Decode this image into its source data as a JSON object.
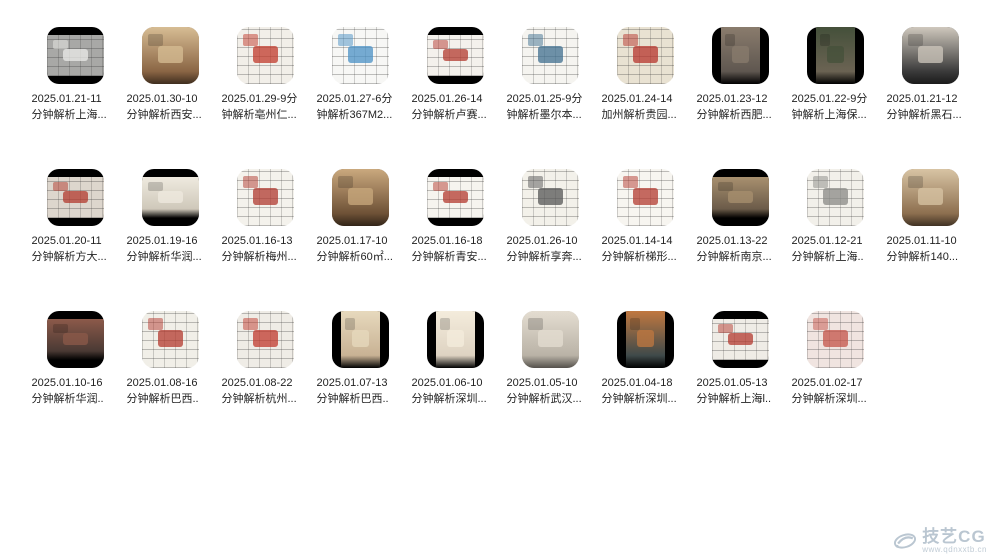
{
  "watermark": {
    "brand": "技艺CG",
    "url": "www.qdnxxtb.cn",
    "color": "#aebdc9"
  },
  "grid": {
    "rows": [
      [
        {
          "date_line": "2025.01.21-11",
          "title_line": "分钟解析上海...",
          "thumb": {
            "kind": "plan",
            "bars": "h",
            "base": "#a8a8a6",
            "accent": "#ebebe8"
          }
        },
        {
          "date_line": "2025.01.30-10",
          "title_line": "分钟解析西安...",
          "thumb": {
            "kind": "photo",
            "bars": "none",
            "base": "#8a6544",
            "accent": "#d7bd94"
          }
        },
        {
          "date_line": "2025.01.29-9分",
          "title_line": "钟解析亳州仁...",
          "thumb": {
            "kind": "plan",
            "bars": "none",
            "base": "#f2efe9",
            "accent": "#c0392b"
          }
        },
        {
          "date_line": "2025.01.27-6分",
          "title_line": "钟解析367M2...",
          "thumb": {
            "kind": "plan",
            "bars": "none",
            "base": "#f7f7f5",
            "accent": "#4a90c4"
          }
        },
        {
          "date_line": "2025.01.26-14",
          "title_line": "分钟解析卢赛...",
          "thumb": {
            "kind": "plan",
            "bars": "h",
            "base": "#f4f1ec",
            "accent": "#b3392f"
          }
        },
        {
          "date_line": "2025.01.25-9分",
          "title_line": "钟解析墨尔本...",
          "thumb": {
            "kind": "plan",
            "bars": "none",
            "base": "#f5f4f0",
            "accent": "#3f6f8f"
          }
        },
        {
          "date_line": "2025.01.24-14",
          "title_line": "加州解析贵园...",
          "thumb": {
            "kind": "plan",
            "bars": "none",
            "base": "#e9e2d2",
            "accent": "#b5342c"
          }
        },
        {
          "date_line": "2025.01.23-12",
          "title_line": "分钟解析西肥...",
          "thumb": {
            "kind": "photo",
            "bars": "v",
            "base": "#5f5750",
            "accent": "#8a7c6d"
          }
        },
        {
          "date_line": "2025.01.22-9分",
          "title_line": "钟解析上海保...",
          "thumb": {
            "kind": "photo",
            "bars": "v",
            "base": "#6b6353",
            "accent": "#44503a"
          }
        },
        {
          "date_line": "2025.01.21-12",
          "title_line": "分钟解析黑石...",
          "thumb": {
            "kind": "photo",
            "bars": "none",
            "base": "#3a3a3a",
            "accent": "#cfc8bd"
          }
        }
      ],
      [
        {
          "date_line": "2025.01.20-11",
          "title_line": "分钟解析方大...",
          "thumb": {
            "kind": "plan",
            "bars": "h",
            "base": "#ddd6cd",
            "accent": "#b23a2e"
          }
        },
        {
          "date_line": "2025.01.19-16",
          "title_line": "分钟解析华润...",
          "thumb": {
            "kind": "photo",
            "bars": "h",
            "base": "#cfc8ba",
            "accent": "#efeadf"
          }
        },
        {
          "date_line": "2025.01.16-13",
          "title_line": "分钟解析梅州...",
          "thumb": {
            "kind": "plan",
            "bars": "none",
            "base": "#f4f2ec",
            "accent": "#b03a30"
          }
        },
        {
          "date_line": "2025.01.17-10",
          "title_line": "分钟解析60㎡...",
          "thumb": {
            "kind": "photo",
            "bars": "none",
            "base": "#6e5136",
            "accent": "#caa97e"
          }
        },
        {
          "date_line": "2025.01.16-18",
          "title_line": "分钟解析青安...",
          "thumb": {
            "kind": "plan",
            "bars": "h",
            "base": "#f6f4ef",
            "accent": "#b3392f"
          }
        },
        {
          "date_line": "2025.01.26-10",
          "title_line": "分钟解析享奔...",
          "thumb": {
            "kind": "plan",
            "bars": "none",
            "base": "#f3f1ea",
            "accent": "#555555"
          }
        },
        {
          "date_line": "2025.01.14-14",
          "title_line": "分钟解析梯形...",
          "thumb": {
            "kind": "plan",
            "bars": "none",
            "base": "#f7f5f0",
            "accent": "#b33a30"
          }
        },
        {
          "date_line": "2025.01.13-22",
          "title_line": "分钟解析南京...",
          "thumb": {
            "kind": "photo",
            "bars": "h",
            "base": "#6b5b49",
            "accent": "#a8906f"
          }
        },
        {
          "date_line": "2025.01.12-21",
          "title_line": "分钟解析上海..",
          "thumb": {
            "kind": "plan",
            "bars": "none",
            "base": "#f2f0ea",
            "accent": "#8a8a85"
          }
        },
        {
          "date_line": "2025.01.11-10",
          "title_line": "分钟解析140...",
          "thumb": {
            "kind": "photo",
            "bars": "none",
            "base": "#8d6f4f",
            "accent": "#d8c4a4"
          }
        }
      ],
      [
        {
          "date_line": "2025.01.10-16",
          "title_line": "分钟解析华润..",
          "thumb": {
            "kind": "photo",
            "bars": "h",
            "base": "#4a3a34",
            "accent": "#8c5a4a"
          }
        },
        {
          "date_line": "2025.01.08-16",
          "title_line": "分钟解析巴西..",
          "thumb": {
            "kind": "plan",
            "bars": "none",
            "base": "#f1efe8",
            "accent": "#b3392f"
          }
        },
        {
          "date_line": "2025.01.08-22",
          "title_line": "分钟解析杭州...",
          "thumb": {
            "kind": "plan",
            "bars": "none",
            "base": "#efece6",
            "accent": "#c03a2e"
          }
        },
        {
          "date_line": "2025.01.07-13",
          "title_line": "分钟解析巴西..",
          "thumb": {
            "kind": "photo",
            "bars": "v",
            "base": "#c8b294",
            "accent": "#e7d9bd"
          }
        },
        {
          "date_line": "2025.01.06-10",
          "title_line": "分钟解析深圳...",
          "thumb": {
            "kind": "photo",
            "bars": "v",
            "base": "#ded3c2",
            "accent": "#f4ecdc"
          }
        },
        {
          "date_line": "2025.01.05-10",
          "title_line": "分钟解析武汉...",
          "thumb": {
            "kind": "photo",
            "bars": "none",
            "base": "#b9b2a6",
            "accent": "#e4ddd1"
          }
        },
        {
          "date_line": "2025.01.04-18",
          "title_line": "分钟解析深圳...",
          "thumb": {
            "kind": "photo",
            "bars": "v",
            "base": "#3f4a4a",
            "accent": "#c07840"
          }
        },
        {
          "date_line": "2025.01.05-13",
          "title_line": "分钟解析上海l..",
          "thumb": {
            "kind": "plan",
            "bars": "h",
            "base": "#efece6",
            "accent": "#b3392f"
          }
        },
        {
          "date_line": "2025.01.02-17",
          "title_line": "分钟解析深圳...",
          "thumb": {
            "kind": "plan",
            "bars": "none",
            "base": "#f0e4e0",
            "accent": "#c4544a"
          }
        }
      ]
    ]
  }
}
